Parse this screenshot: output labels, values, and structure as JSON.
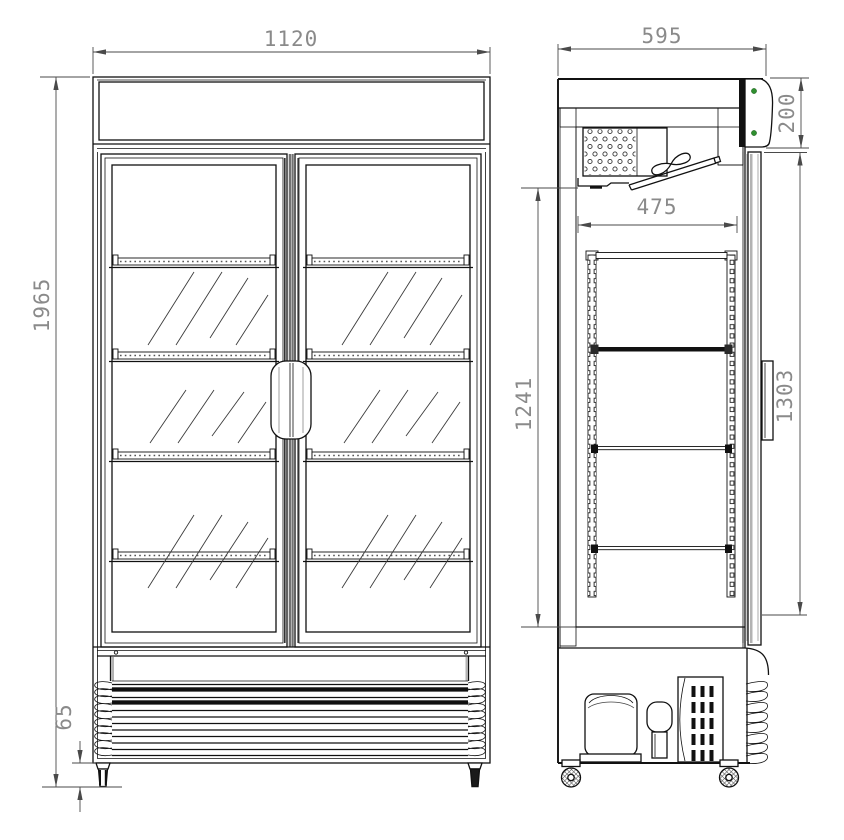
{
  "drawing": {
    "kind": "technical-drawing",
    "views": {
      "front": {
        "name": "front view"
      },
      "side": {
        "name": "side section view"
      }
    }
  },
  "dimensions": {
    "front_width": "1120",
    "front_height": "1965",
    "front_caster_height": "65",
    "side_depth": "595",
    "side_header_height": "200",
    "side_interior_depth": "475",
    "side_interior_height": "1241",
    "side_door_height": "1303"
  },
  "colors": {
    "line": "#111111",
    "dim_line": "#4a4a4a",
    "dim_text": "#8a8a8a",
    "shading": "#b3b3b3",
    "indicator_dot": "#2f8f2f",
    "background": "#ffffff"
  }
}
